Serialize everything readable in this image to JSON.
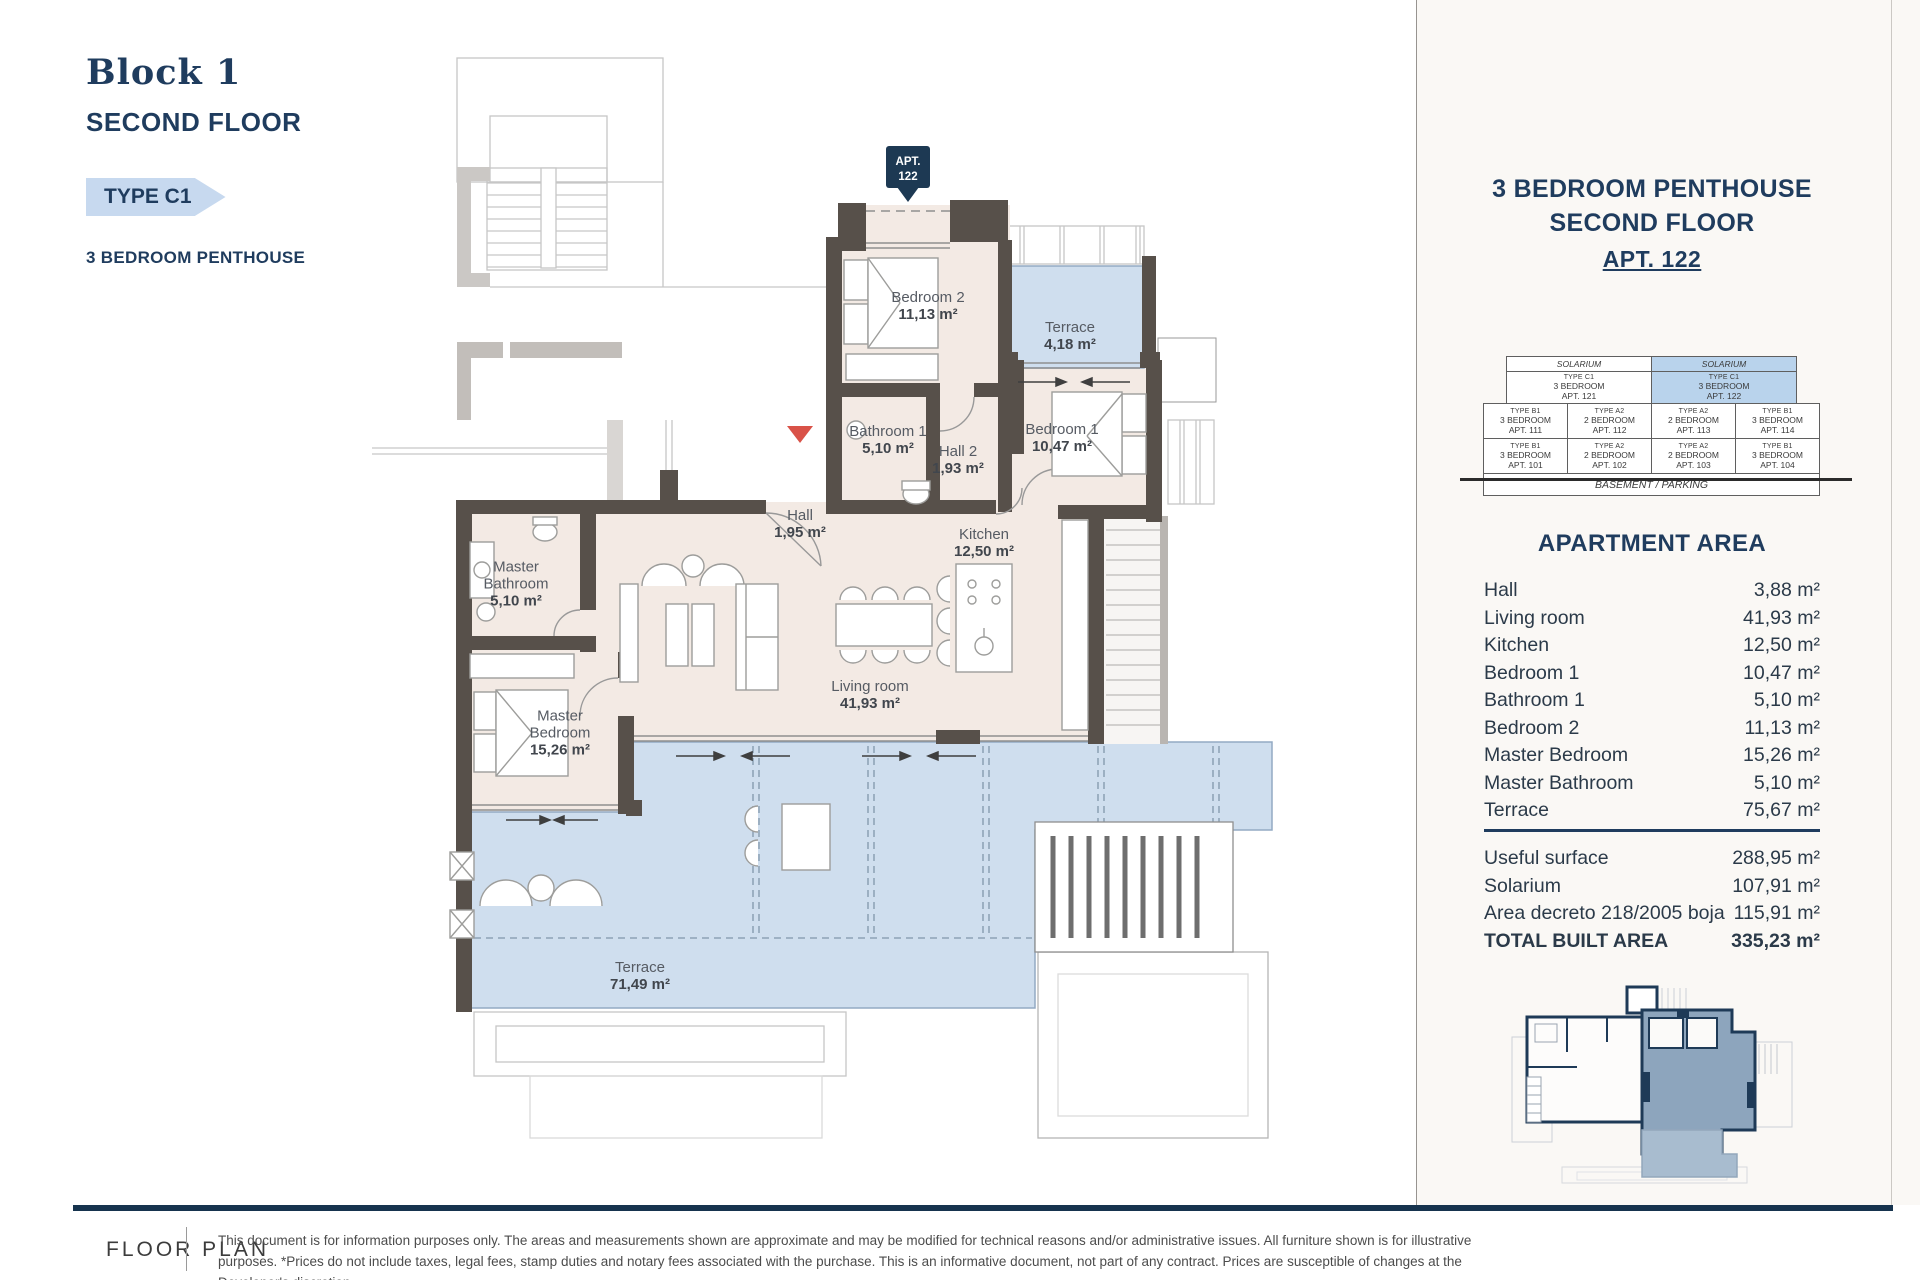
{
  "header": {
    "block": "Block 1",
    "floor": "SECOND FLOOR",
    "type": "TYPE C1",
    "subtitle": "3 BEDROOM PENTHOUSE"
  },
  "plan": {
    "apt_flag": {
      "line1": "APT.",
      "line2": "122"
    },
    "rooms": [
      {
        "name": "Bedroom 2",
        "area": "11,13 m²"
      },
      {
        "name": "Terrace",
        "area": "4,18 m²"
      },
      {
        "name": "Bathroom 1",
        "area": "5,10 m²"
      },
      {
        "name": "Hall 2",
        "area": "1,93 m²"
      },
      {
        "name": "Bedroom 1",
        "area": "10,47 m²"
      },
      {
        "name": "Hall",
        "area": "1,95 m²"
      },
      {
        "name": "Kitchen",
        "area": "12,50 m²"
      },
      {
        "name": "Living room",
        "area": "41,93 m²"
      },
      {
        "name": "Master Bathroom",
        "area": "5,10 m²"
      },
      {
        "name": "Master Bedroom",
        "area": "15,26 m²"
      },
      {
        "name": "Terrace",
        "area": "71,49 m²"
      }
    ]
  },
  "sidebar": {
    "title_line1": "3 BEDROOM PENTHOUSE",
    "title_line2": "SECOND FLOOR",
    "apt_label": "APT. 122",
    "stack": {
      "solarium_left": "SOLARIUM",
      "solarium_right": "SOLARIUM",
      "penthouses": [
        {
          "type": "TYPE C1",
          "beds": "3 BEDROOM",
          "apt": "APT. 121"
        },
        {
          "type": "TYPE C1",
          "beds": "3 BEDROOM",
          "apt": "APT. 122"
        }
      ],
      "floor2": [
        {
          "type": "TYPE B1",
          "beds": "3 BEDROOM",
          "apt": "APT. 111"
        },
        {
          "type": "TYPE A2",
          "beds": "2 BEDROOM",
          "apt": "APT. 112"
        },
        {
          "type": "TYPE A2",
          "beds": "2 BEDROOM",
          "apt": "APT. 113"
        },
        {
          "type": "TYPE B1",
          "beds": "3 BEDROOM",
          "apt": "APT. 114"
        }
      ],
      "floor1": [
        {
          "type": "TYPE B1",
          "beds": "3 BEDROOM",
          "apt": "APT. 101"
        },
        {
          "type": "TYPE A2",
          "beds": "2 BEDROOM",
          "apt": "APT. 102"
        },
        {
          "type": "TYPE A2",
          "beds": "2 BEDROOM",
          "apt": "APT. 103"
        },
        {
          "type": "TYPE B1",
          "beds": "3 BEDROOM",
          "apt": "APT. 104"
        }
      ],
      "basement": "BASEMENT / PARKING"
    },
    "area_heading": "APARTMENT AREA",
    "areas": [
      {
        "label": "Hall",
        "value": "3,88 m²"
      },
      {
        "label": "Living room",
        "value": "41,93 m²"
      },
      {
        "label": "Kitchen",
        "value": "12,50 m²"
      },
      {
        "label": "Bedroom 1",
        "value": "10,47 m²"
      },
      {
        "label": "Bathroom 1",
        "value": "5,10 m²"
      },
      {
        "label": "Bedroom 2",
        "value": "11,13 m²"
      },
      {
        "label": "Master Bedroom",
        "value": "15,26 m²"
      },
      {
        "label": "Master Bathroom",
        "value": "5,10 m²"
      },
      {
        "label": "Terrace",
        "value": "75,67 m²"
      }
    ],
    "totals": [
      {
        "label": "Useful surface",
        "value": "288,95 m²"
      },
      {
        "label": "Solarium",
        "value": "107,91 m²"
      },
      {
        "label": "Area decreto 218/2005 boja",
        "value": "115,91 m²"
      },
      {
        "label": "TOTAL BUILT AREA",
        "value": "335,23 m²"
      }
    ]
  },
  "footer": {
    "label": "FLOOR PLAN",
    "disclaimer": "This document is for information purposes only. The areas and measurements shown are approximate and may be modified for technical reasons and/or administrative issues. All furniture shown is for illustrative purposes. *Prices do not include taxes, legal fees, stamp duties and notary fees associated with the purchase. This is an informative document, not part of any contract. Prices are susceptible of changes at the Developer's discretion."
  },
  "colors": {
    "navy": "#1f3c5e",
    "wall": "#57504a",
    "room_fill": "#f3eae4",
    "terrace_fill": "#cfdeee",
    "highlight_blue": "#b9d3ec",
    "banner_blue": "#c7d9ef",
    "accent_red": "#d95248"
  }
}
